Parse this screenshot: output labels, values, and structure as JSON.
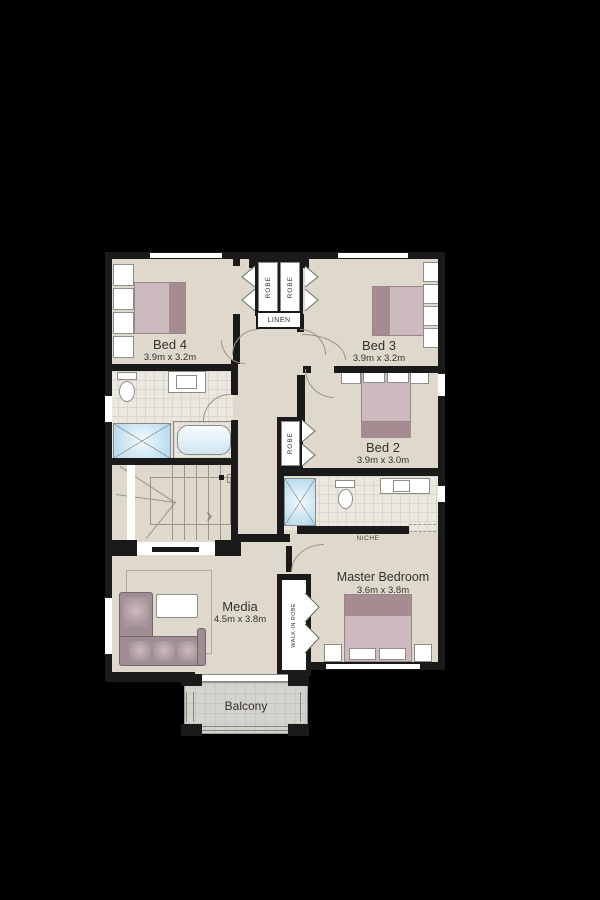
{
  "rooms": {
    "bed4": {
      "name": "Bed 4",
      "size": "3.9m x 3.2m"
    },
    "bed3": {
      "name": "Bed 3",
      "size": "3.9m x 3.2m"
    },
    "bed2": {
      "name": "Bed 2",
      "size": "3.9m x 3.0m"
    },
    "master": {
      "name": "Master Bedroom",
      "size": "3.6m x 3.8m"
    },
    "media": {
      "name": "Media",
      "size": "4.5m x 3.8m"
    },
    "balcony": {
      "name": "Balcony"
    }
  },
  "storage": {
    "robe_bed4": "ROBE",
    "robe_bed3": "ROBE",
    "robe_bed2": "ROBE",
    "linen": "LINEN",
    "walk_in_robe": "WALK-IN ROBE"
  },
  "annotations": {
    "niche": "NICHE"
  },
  "colors": {
    "background": "#000000",
    "floor": "#ded9cc",
    "wall": "#1a1a1a",
    "bed_light": "#cdbabe",
    "bed_dark": "#a68c90",
    "shower_blue": "#b4d9ec",
    "tile": "#ebe8e1",
    "balcony_deck": "#d5d3cd"
  }
}
